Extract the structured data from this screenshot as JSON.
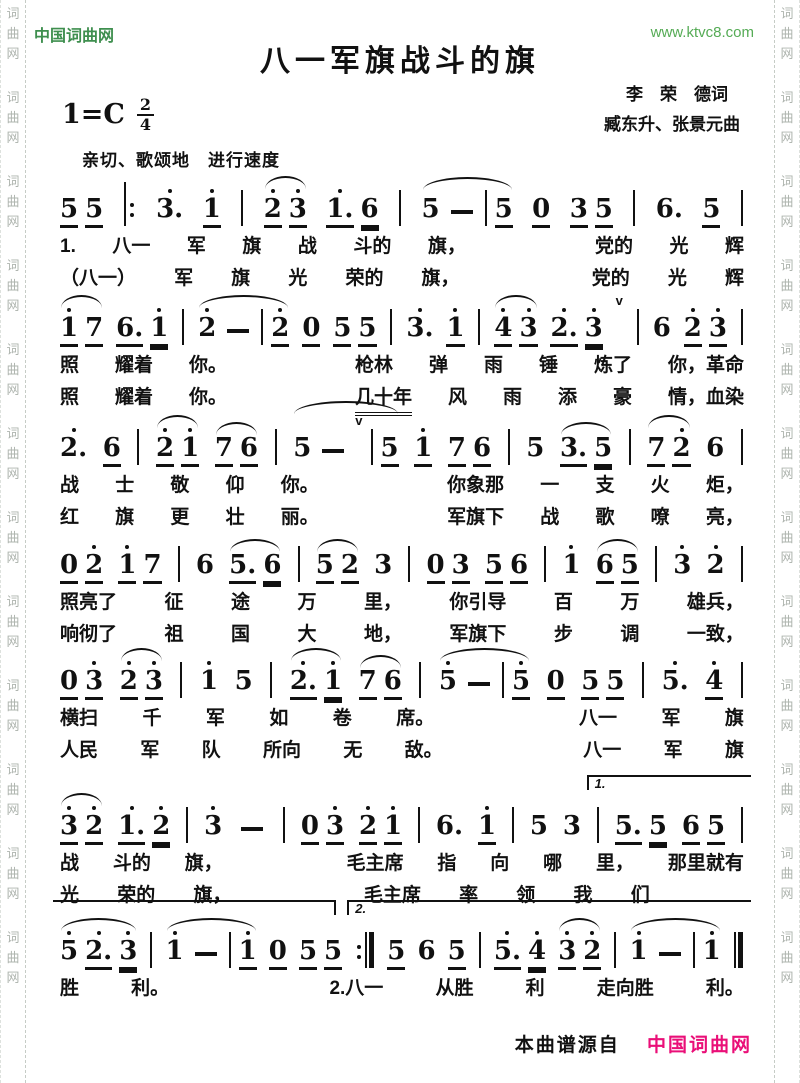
{
  "header": {
    "site_name": "中国词曲网",
    "site_url": "www.ktvc8.com",
    "title": "八一军旗战斗的旗",
    "lyricist": "李　荣　德词",
    "composer": "臧东升、张景元曲",
    "key_signature": "1=C",
    "time_top": "2",
    "time_bottom": "4",
    "tempo": "亲切、歌颂地　进行速度"
  },
  "watermark": {
    "chars": [
      "词",
      "曲",
      "网"
    ],
    "repeat": 12
  },
  "footer": {
    "source_prefix": "本曲谱源自",
    "source_site": "中国词曲网"
  },
  "colors": {
    "site_green": "#3f8f4f",
    "url_green": "#55ab55",
    "footer_pink": "#ea0f78",
    "ink": "#111111",
    "watermark_grey": "#aeb4ae"
  },
  "music": [
    {
      "cells": [
        {
          "g": [
            {
              "n": "5",
              "u": 1
            },
            {
              "n": "5",
              "u": 1
            }
          ]
        },
        {
          "b": "begin"
        },
        {
          "n": "3.",
          "hi": 1
        },
        {
          "n": "1",
          "hi": 1,
          "u": 1
        },
        {
          "b": "bar"
        },
        {
          "g": [
            {
              "n": "2",
              "hi": 1,
              "u": 1
            },
            {
              "n": "3",
              "hi": 1,
              "u": 1
            }
          ],
          "slur": 1
        },
        {
          "g": [
            {
              "n": "1.",
              "hi": 1,
              "u": 1
            },
            {
              "n": "6",
              "u": 2
            }
          ]
        },
        {
          "b": "bar"
        },
        {
          "g": [
            {
              "n": "5"
            },
            {
              "n": "-"
            },
            {
              "b": "bar"
            },
            {
              "n": "5",
              "u": 1
            }
          ],
          "slur": 1
        },
        {
          "n": "0",
          "u": 1
        },
        {
          "g": [
            {
              "n": "3",
              "u": 1
            },
            {
              "n": "5",
              "u": 1
            }
          ]
        },
        {
          "b": "bar"
        },
        {
          "n": "6."
        },
        {
          "n": "5",
          "u": 1
        },
        {
          "b": "bar"
        }
      ],
      "lyrics": [
        [
          "1.",
          "八一",
          "军",
          "旗",
          "战",
          "斗的",
          "旗，",
          "",
          "党的",
          "光",
          "辉"
        ],
        [
          "（八一）",
          "军",
          "旗",
          "光",
          "荣的",
          "旗，",
          "",
          "党的",
          "光",
          "辉"
        ]
      ]
    },
    {
      "cells": [
        {
          "g": [
            {
              "n": "1",
              "hi": 1,
              "u": 1
            },
            {
              "n": "7",
              "u": 1
            }
          ],
          "slur": 1
        },
        {
          "g": [
            {
              "n": "6.",
              "u": 1
            },
            {
              "n": "1",
              "hi": 1,
              "u": 2
            }
          ]
        },
        {
          "b": "bar"
        },
        {
          "g": [
            {
              "n": "2",
              "hi": 1
            },
            {
              "n": "-"
            },
            {
              "b": "bar"
            },
            {
              "n": "2",
              "hi": 1,
              "u": 1
            }
          ],
          "slur": 1
        },
        {
          "n": "0",
          "u": 1
        },
        {
          "g": [
            {
              "n": "5",
              "u": 1
            },
            {
              "n": "5",
              "u": 1
            }
          ]
        },
        {
          "b": "bar"
        },
        {
          "n": "3.",
          "hi": 1
        },
        {
          "n": "1",
          "hi": 1,
          "u": 1
        },
        {
          "b": "bar"
        },
        {
          "g": [
            {
              "n": "4",
              "hi": 1,
              "u": 1
            },
            {
              "n": "3",
              "hi": 1,
              "u": 1
            }
          ],
          "slur": 1
        },
        {
          "g": [
            {
              "n": "2.",
              "hi": 1,
              "u": 1
            },
            {
              "n": "3",
              "hi": 1,
              "u": 2
            }
          ]
        },
        {
          "v": 1
        },
        {
          "b": "bar"
        },
        {
          "n": "6"
        },
        {
          "g": [
            {
              "n": "2",
              "hi": 1,
              "u": 1
            },
            {
              "n": "3",
              "hi": 1,
              "u": 1
            }
          ]
        },
        {
          "b": "bar"
        }
      ],
      "lyrics": [
        [
          "照",
          "耀着",
          "你。",
          "",
          "枪林",
          "弹",
          "雨",
          "锤",
          "炼了",
          "你，革命"
        ],
        [
          "照",
          "耀着",
          "你。",
          "",
          {
            "t": "几十年",
            "u": 1
          },
          "风",
          "雨",
          "添",
          "豪",
          "情，血染"
        ]
      ]
    },
    {
      "cells": [
        {
          "n": "2.",
          "hi": 1
        },
        {
          "n": "6",
          "u": 1
        },
        {
          "b": "bar"
        },
        {
          "g": [
            {
              "n": "2",
              "hi": 1,
              "u": 1
            },
            {
              "n": "1",
              "hi": 1,
              "u": 1
            }
          ],
          "slur": 1
        },
        {
          "g": [
            {
              "n": "7",
              "u": 1
            },
            {
              "n": "6",
              "u": 1
            }
          ],
          "slur": 1
        },
        {
          "b": "bar"
        },
        {
          "g": [
            {
              "n": "5"
            },
            {
              "n": "-"
            },
            {
              "v": 1
            },
            {
              "b": "bar"
            },
            {
              "n": "5",
              "u": 1
            }
          ],
          "slur": 1
        },
        {
          "n": "1",
          "hi": 1,
          "u": 1
        },
        {
          "g": [
            {
              "n": "7",
              "u": 1
            },
            {
              "n": "6",
              "u": 1
            }
          ]
        },
        {
          "b": "bar"
        },
        {
          "n": "5"
        },
        {
          "g": [
            {
              "n": "3.",
              "u": 1
            },
            {
              "n": "5",
              "u": 2
            }
          ],
          "slur": 1
        },
        {
          "b": "bar"
        },
        {
          "g": [
            {
              "n": "7",
              "u": 1
            },
            {
              "n": "2",
              "hi": 1,
              "u": 1
            }
          ],
          "slur": 1
        },
        {
          "n": "6"
        },
        {
          "b": "bar"
        }
      ],
      "lyrics": [
        [
          "战",
          "士",
          "敬",
          "仰",
          "你。",
          "",
          "你象那",
          "一",
          "支",
          "火",
          "炬，"
        ],
        [
          "红",
          "旗",
          "更",
          "壮",
          "丽。",
          "",
          "军旗下",
          "战",
          "歌",
          "嘹",
          "亮，"
        ]
      ]
    },
    {
      "cells": [
        {
          "g": [
            {
              "n": "0",
              "u": 1
            },
            {
              "n": "2",
              "hi": 1,
              "u": 1
            }
          ]
        },
        {
          "g": [
            {
              "n": "1",
              "hi": 1,
              "u": 1
            },
            {
              "n": "7",
              "u": 1
            }
          ]
        },
        {
          "b": "bar"
        },
        {
          "n": "6"
        },
        {
          "g": [
            {
              "n": "5.",
              "u": 1
            },
            {
              "n": "6",
              "u": 2
            }
          ],
          "slur": 1
        },
        {
          "b": "bar"
        },
        {
          "g": [
            {
              "n": "5",
              "u": 1
            },
            {
              "n": "2",
              "u": 1
            }
          ],
          "slur": 1
        },
        {
          "n": "3"
        },
        {
          "b": "bar"
        },
        {
          "g": [
            {
              "n": "0",
              "u": 1
            },
            {
              "n": "3",
              "u": 1
            }
          ]
        },
        {
          "g": [
            {
              "n": "5",
              "u": 1
            },
            {
              "n": "6",
              "u": 1
            }
          ]
        },
        {
          "b": "bar"
        },
        {
          "n": "1",
          "hi": 1
        },
        {
          "g": [
            {
              "n": "6",
              "u": 1
            },
            {
              "n": "5",
              "u": 1
            }
          ],
          "slur": 1
        },
        {
          "b": "bar"
        },
        {
          "n": "3",
          "hi": 1
        },
        {
          "n": "2",
          "hi": 1
        },
        {
          "b": "bar"
        }
      ],
      "lyrics": [
        [
          "照亮了",
          "征",
          "途",
          "万",
          "里，",
          "你引导",
          "百",
          "万",
          "雄兵，"
        ],
        [
          "响彻了",
          "祖",
          "国",
          "大",
          "地，",
          "军旗下",
          "步",
          "调",
          "一致，"
        ]
      ]
    },
    {
      "cells": [
        {
          "g": [
            {
              "n": "0",
              "u": 1
            },
            {
              "n": "3",
              "hi": 1,
              "u": 1
            }
          ]
        },
        {
          "g": [
            {
              "n": "2",
              "hi": 1,
              "u": 1
            },
            {
              "n": "3",
              "hi": 1,
              "u": 1
            }
          ],
          "slur": 1
        },
        {
          "b": "bar"
        },
        {
          "n": "1",
          "hi": 1
        },
        {
          "n": "5"
        },
        {
          "b": "bar"
        },
        {
          "g": [
            {
              "n": "2.",
              "hi": 1,
              "u": 1
            },
            {
              "n": "1",
              "hi": 1,
              "u": 2
            }
          ],
          "slur": 1
        },
        {
          "g": [
            {
              "n": "7",
              "u": 1
            },
            {
              "n": "6",
              "u": 1
            }
          ],
          "slur": 1
        },
        {
          "b": "bar"
        },
        {
          "g": [
            {
              "n": "5",
              "hi": 1
            },
            {
              "n": "-"
            },
            {
              "b": "bar"
            },
            {
              "n": "5",
              "hi": 1,
              "u": 1
            }
          ],
          "slur": 1
        },
        {
          "n": "0",
          "u": 1
        },
        {
          "g": [
            {
              "n": "5",
              "u": 1
            },
            {
              "n": "5",
              "u": 1
            }
          ]
        },
        {
          "b": "bar"
        },
        {
          "n": "5.",
          "hi": 1
        },
        {
          "n": "4",
          "hi": 1,
          "u": 1
        },
        {
          "b": "bar"
        }
      ],
      "lyrics": [
        [
          "横扫",
          "千",
          "军",
          "如",
          "卷",
          "席。",
          "",
          "八一",
          "军",
          "旗"
        ],
        [
          "人民",
          "军",
          "队",
          "所向",
          "无",
          "敌。",
          "",
          "八一",
          "军",
          "旗"
        ]
      ]
    },
    {
      "voltas": [
        {
          "cls": "v6a",
          "label": "1."
        }
      ],
      "cells": [
        {
          "g": [
            {
              "n": "3",
              "hi": 1,
              "u": 1
            },
            {
              "n": "2",
              "hi": 1,
              "u": 1
            }
          ],
          "slur": 1
        },
        {
          "g": [
            {
              "n": "1.",
              "hi": 1,
              "u": 1
            },
            {
              "n": "2",
              "hi": 1,
              "u": 2
            }
          ]
        },
        {
          "b": "bar"
        },
        {
          "n": "3",
          "hi": 1
        },
        {
          "n": "-"
        },
        {
          "b": "bar"
        },
        {
          "g": [
            {
              "n": "0",
              "u": 1
            },
            {
              "n": "3",
              "hi": 1,
              "u": 1
            }
          ]
        },
        {
          "g": [
            {
              "n": "2",
              "hi": 1,
              "u": 1
            },
            {
              "n": "1",
              "hi": 1,
              "u": 1
            }
          ]
        },
        {
          "b": "bar"
        },
        {
          "n": "6."
        },
        {
          "n": "1",
          "hi": 1,
          "u": 1
        },
        {
          "b": "bar"
        },
        {
          "n": "5"
        },
        {
          "n": "3"
        },
        {
          "b": "bar"
        },
        {
          "g": [
            {
              "n": "5.",
              "u": 1
            },
            {
              "n": "5",
              "u": 2
            }
          ]
        },
        {
          "g": [
            {
              "n": "6",
              "u": 1
            },
            {
              "n": "5",
              "u": 1
            }
          ]
        },
        {
          "b": "bar"
        }
      ],
      "lyrics": [
        [
          "战",
          "斗的",
          "旗，",
          "",
          "毛主席",
          "指",
          "向",
          "哪",
          "里，",
          "那里就有"
        ],
        [
          "光",
          "荣的",
          "旗，",
          "",
          "毛主席",
          "率",
          "领",
          "我",
          "们",
          ""
        ]
      ]
    },
    {
      "voltas": [
        {
          "cls": "v7a",
          "label": ""
        },
        {
          "cls": "v7b",
          "label": "2."
        }
      ],
      "cells": [
        {
          "g": [
            {
              "n": "5",
              "hi": 1
            },
            {
              "n": "2.",
              "hi": 1,
              "u": 1
            },
            {
              "n": "3",
              "hi": 1,
              "u": 2
            }
          ],
          "slur": 1
        },
        {
          "b": "bar"
        },
        {
          "g": [
            {
              "n": "1",
              "hi": 1
            },
            {
              "n": "-"
            },
            {
              "b": "bar"
            },
            {
              "n": "1",
              "hi": 1,
              "u": 1
            }
          ],
          "slur": 1
        },
        {
          "n": "0",
          "u": 1
        },
        {
          "g": [
            {
              "n": "5",
              "u": 1
            },
            {
              "n": "5",
              "u": 1
            }
          ]
        },
        {
          "b": "end"
        },
        {
          "n": "5",
          "u": 1
        },
        {
          "n": "6"
        },
        {
          "n": "5",
          "u": 1
        },
        {
          "b": "bar"
        },
        {
          "g": [
            {
              "n": "5.",
              "hi": 1,
              "u": 1
            },
            {
              "n": "4",
              "hi": 1,
              "u": 2
            }
          ]
        },
        {
          "g": [
            {
              "n": "3",
              "hi": 1,
              "u": 1
            },
            {
              "n": "2",
              "hi": 1,
              "u": 1
            }
          ],
          "slur": 1
        },
        {
          "b": "bar"
        },
        {
          "g": [
            {
              "n": "1",
              "hi": 1
            },
            {
              "n": "-"
            },
            {
              "b": "bar"
            },
            {
              "n": "1",
              "hi": 1
            }
          ],
          "slur": 1
        },
        {
          "b": "final"
        }
      ],
      "lyrics": [
        [
          "胜",
          "利。",
          "",
          "2.八一",
          "从胜",
          "利",
          "走向胜",
          "利。"
        ]
      ]
    }
  ]
}
